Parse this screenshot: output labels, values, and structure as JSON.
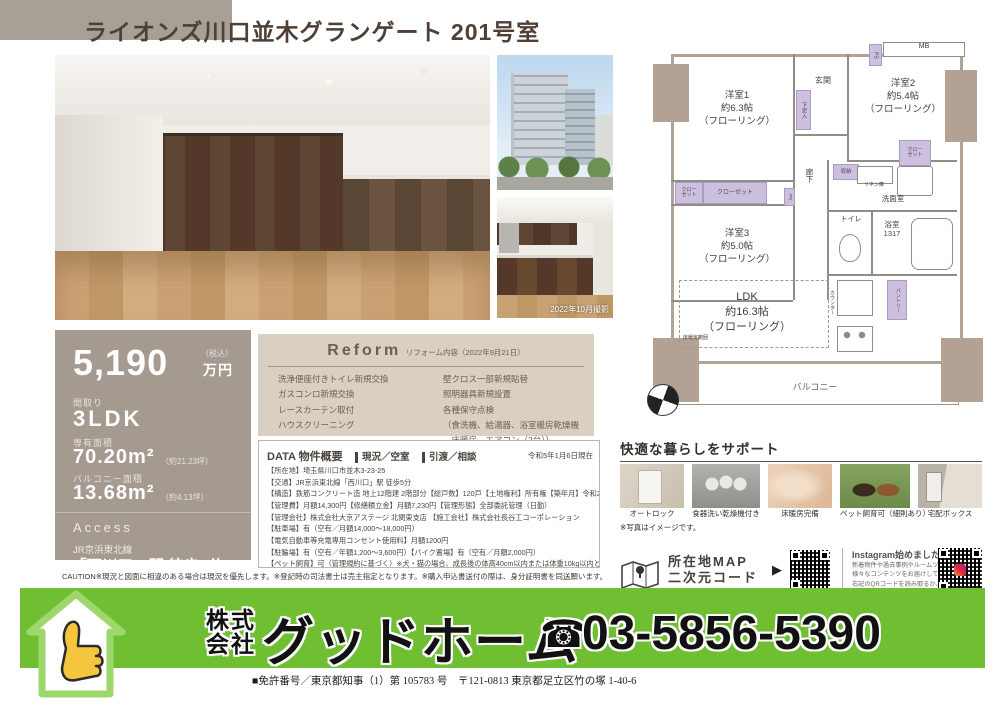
{
  "title": "ライオンズ川口並木グランゲート 201号室",
  "photos": {
    "shoot_date": "2022年10月撮影"
  },
  "price_panel": {
    "price": "5,190",
    "tax_note": "（税込）",
    "unit": "万円",
    "layout_label": "間取り",
    "layout": "3LDK",
    "area_label": "専有面積",
    "area": "70.20m²",
    "area_tsubo": "（約21.23坪）",
    "balcony_label": "バルコニー面積",
    "balcony": "13.68m²",
    "balcony_tsubo": "（約4.13坪）",
    "access_label": "Access",
    "rail_line": "JR京浜東北線",
    "station": "「西川口」駅 徒歩5分"
  },
  "reform": {
    "heading": "Reform",
    "subheading": "リフォーム内容（2022年9月21日）",
    "left_items": [
      "洗浄便座付きトイレ新規交換",
      "ガスコンロ新規交換",
      "レースカーテン取付",
      "ハウスクリーニング"
    ],
    "right_items": [
      "壁クロス一部新規貼替",
      "照明器具新規設置",
      "各種保守点検",
      "（食洗機、給湯器、浴室暖房乾燥機",
      "　床暖房、エアコン（2台））"
    ]
  },
  "data_section": {
    "heading": "DATA 物件概要",
    "status": "現況／空室",
    "handover": "引渡／相談",
    "as_of": "令和5年1月6日現在",
    "lines": [
      "【所在地】埼玉県川口市並木3-23-25",
      "【交通】JR京浜東北線「西川口」駅 徒歩5分",
      "【構造】鉄筋コンクリート造 地上12階建 2階部分【総戸数】120戸【土地権利】所有権【築年月】令和2年1月",
      "【管理費】月額14,300円【修繕積立金】月額7,230円【管理形態】全部委託管理（日勤）",
      "【管理会社】株式会社大京アステージ 北関東支店 【施工会社】株式会社長谷工コーポレーション",
      "【駐車場】有（空有／月額14,000～18,000円）",
      "【電気自動車等充電専用コンセント使用料】月額1200円",
      "【駐輪場】有（空有／年額1,200～3,600円）【バイク置場】有（空有／月額2,000円）",
      "【ペット飼育】可（管理規約に基づく）※犬・猫の場合、成長後の体高40cm以内または体重10kg以内とし、1住戸2匹まで"
    ]
  },
  "caution": "CAUTION※現況と図面に相違のある場合は現況を優先します。※登記時の司法書士は売主指定となります。※購入申込書送付の際は、身分証明書を同送願います。",
  "floorplan": {
    "room1": "洋室1\n約6.3帖\n（フローリング）",
    "room2": "洋室2\n約5.4帖\n（フローリング）",
    "room3": "洋室3\n約5.0帖\n（フローリング）",
    "ldk": "LDK\n約16.3帖\n（フローリング）",
    "genkan": "玄関",
    "shoe": "下足入",
    "hall": "廊下",
    "storage": "収納",
    "closet_a": "クローゼット",
    "closet_b": "クロー\nゼット",
    "closet_c": "クロー\nゼット",
    "linen": "リネン庫",
    "wash": "洗面室",
    "toilet": "トイレ",
    "bath": "浴室\n1317",
    "mb": "MB",
    "ps": "PS",
    "ps2": "PS",
    "counter": "カウンター",
    "pantry": "パントリー",
    "heating": "床暖房範囲",
    "balcony": "バルコニー"
  },
  "support": {
    "heading": "快適な暮らしをサポート",
    "items": [
      "オートロック",
      "食器洗い乾燥機付き",
      "床暖房完備",
      "ペット飼育可（細則あり）",
      "宅配ボックス"
    ],
    "note": "※写真はイメージです。"
  },
  "map_qr": {
    "map_label": "所在地MAP\n二次元コード",
    "arrow": "▶",
    "insta_heading": "Instagram始めました！",
    "insta_lines": [
      "新着物件や過去事例やルームツアー動画など",
      "様々なコンテンツをお届けしています。",
      "右記のQRコードを読み取るか、",
      "@starmica_groupでぜひご検索ください！"
    ]
  },
  "footer": {
    "company_stack1": "株式",
    "company_stack2": "会社",
    "company_name": "グッドホーム",
    "phone_icon": "☎",
    "phone": "03-5856-5390",
    "license_address": "■免許番号／東京都知事（1）第 105783 号　〒121-0813 東京都足立区竹の塚 1-40-6"
  }
}
